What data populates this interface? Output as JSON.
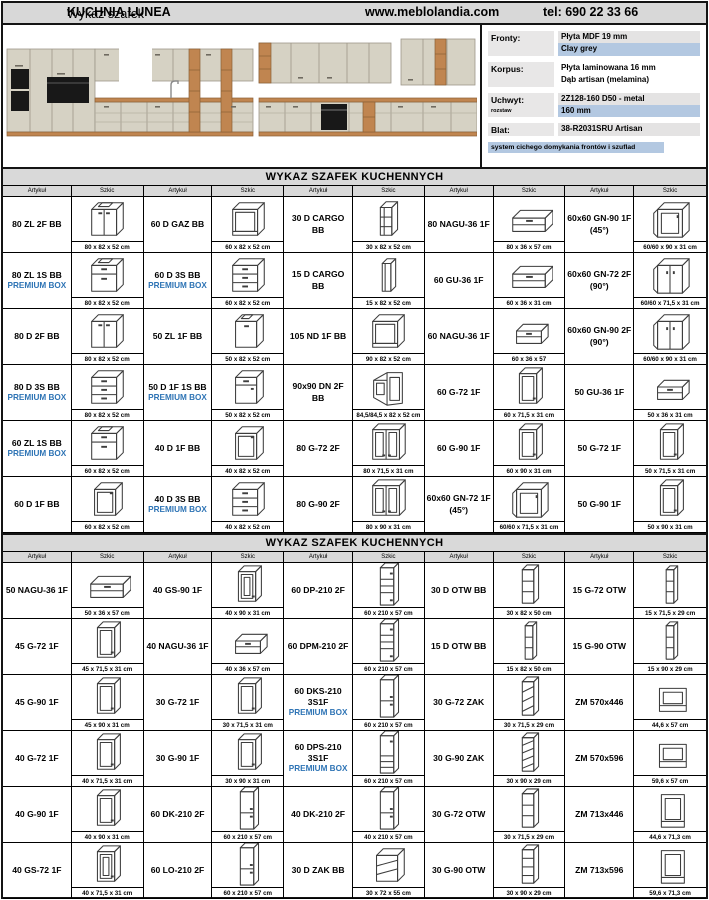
{
  "header": {
    "title_prefix": "Wykaz szafek ",
    "title_name": "KUCHNIA LUNEA",
    "website": "www.meblolandia.com",
    "phone": "tel: 690 22 33 66"
  },
  "colors": {
    "premium_blue": "#2e74b5",
    "highlight_blue": "#b3c8e1",
    "header_grey": "#d9d9d9"
  },
  "specs": {
    "rows": [
      {
        "label": "Fronty:",
        "sublabel": "",
        "values": [
          {
            "text": "Płyta MDF 19 mm",
            "style": "grey"
          },
          {
            "text": "Clay grey",
            "style": "blue"
          }
        ]
      },
      {
        "label": "Korpus:",
        "sublabel": "",
        "values": [
          {
            "text": "Płyta laminowana 16 mm",
            "style": "plain"
          },
          {
            "text": "Dąb artisan (melamina)",
            "style": "plain"
          }
        ]
      },
      {
        "label": "Uchwyt:",
        "sublabel": "rozstaw",
        "values": [
          {
            "text": "2Z128-160 D50 - metal",
            "style": "grey"
          },
          {
            "text": "160 mm",
            "style": "blue"
          }
        ]
      },
      {
        "label": "Blat:",
        "sublabel": "",
        "values": [
          {
            "text": "38-R2031SRU Artisan",
            "style": "grey"
          }
        ]
      }
    ],
    "footer": "system cichego domykania frontów i szuflad"
  },
  "sections": [
    {
      "title": "WYKAZ SZAFEK KUCHENNYCH",
      "col_headers": {
        "article": "Artykuł",
        "sketch": "Szkic"
      },
      "rows": [
        [
          {
            "code": "80 ZL 2F BB",
            "dims": "80 x 82 x 52 cm",
            "sketch": "sink-base-2-doors"
          },
          {
            "code": "60 D GAZ BB",
            "dims": "60 x 82 x 52 cm",
            "sketch": "open-base"
          },
          {
            "code": "30 D CARGO BB",
            "dims": "30 x 82 x 52 cm",
            "sketch": "cargo"
          },
          {
            "code": "80 NAGU-36 1F",
            "dims": "80 x 36 x 57 cm",
            "sketch": "flip-up-wall"
          },
          {
            "code": "60x60 GN-90 1F",
            "code2": "(45°)",
            "dims": "60/60 x 90 x 31 cm",
            "sketch": "corner-wall-1f"
          }
        ],
        [
          {
            "code": "80 ZL 1S BB",
            "premium": "PREMIUM BOX",
            "dims": "80 x 82 x 52 cm",
            "sketch": "sink-base-drawer"
          },
          {
            "code": "60 D 3S BB",
            "premium": "PREMIUM BOX",
            "dims": "60 x 82 x 52 cm",
            "sketch": "drawer-base-3"
          },
          {
            "code": "15 D CARGO BB",
            "dims": "15 x 82 x 52 cm",
            "sketch": "cargo-narrow"
          },
          {
            "code": "60 GU-36 1F",
            "dims": "60 x 36 x 31 cm",
            "sketch": "flip-up-wall"
          },
          {
            "code": "60x60 GN-72 2F",
            "code2": "(90°)",
            "dims": "60/60 x 71,5 x 31 cm",
            "sketch": "corner-wall-2f"
          }
        ],
        [
          {
            "code": "80 D 2F BB",
            "dims": "80 x 82 x 52 cm",
            "sketch": "base-2-doors"
          },
          {
            "code": "50 ZL 1F BB",
            "dims": "50 x 82 x 52 cm",
            "sketch": "sink-base-1-door"
          },
          {
            "code": "105 ND 1F BB",
            "dims": "90 x 82 x 52 cm",
            "sketch": "open-base"
          },
          {
            "code": "60 NAGU-36 1F",
            "dims": "60 x 36 x 57",
            "sketch": "flip-up-wall-small"
          },
          {
            "code": "60x60 GN-90 2F",
            "code2": "(90°)",
            "dims": "60/60 x 90 x 31 cm",
            "sketch": "corner-wall-2f"
          }
        ],
        [
          {
            "code": "80 D 3S BB",
            "premium": "PREMIUM BOX",
            "dims": "80 x 82 x 52 cm",
            "sketch": "drawer-base-3"
          },
          {
            "code": "50 D 1F 1S BB",
            "premium": "PREMIUM BOX",
            "dims": "50 x 82 x 52 cm",
            "sketch": "drawer-door-base"
          },
          {
            "code": "90x90 DN 2F BB",
            "dims": "84,5/84,5 x 82 x 52 cm",
            "sketch": "corner-base"
          },
          {
            "code": "60 G-72 1F",
            "dims": "60 x 71,5 x 31 cm",
            "sketch": "wall-1-door"
          },
          {
            "code": "50 GU-36 1F",
            "dims": "50 x 36 x 31 cm",
            "sketch": "flip-up-wall-small"
          }
        ],
        [
          {
            "code": "60 ZL 1S BB",
            "premium": "PREMIUM BOX",
            "dims": "60 x 82 x 52 cm",
            "sketch": "sink-base-drawer"
          },
          {
            "code": "40 D 1F BB",
            "dims": "40 x 82 x 52 cm",
            "sketch": "base-1-door"
          },
          {
            "code": "80 G-72 2F",
            "dims": "80 x 71,5 x 31 cm",
            "sketch": "wall-2-doors"
          },
          {
            "code": "60 G-90 1F",
            "dims": "60 x 90 x 31 cm",
            "sketch": "wall-1-door"
          },
          {
            "code": "50 G-72 1F",
            "dims": "50 x 71,5 x 31 cm",
            "sketch": "wall-1-door"
          }
        ],
        [
          {
            "code": "60 D 1F BB",
            "dims": "60 x 82 x 52 cm",
            "sketch": "base-1-door"
          },
          {
            "code": "40 D 3S BB",
            "premium": "PREMIUM BOX",
            "dims": "40 x 82 x 52 cm",
            "sketch": "drawer-base-3"
          },
          {
            "code": "80 G-90 2F",
            "dims": "80 x 90 x 31 cm",
            "sketch": "wall-2-doors"
          },
          {
            "code": "60x60 GN-72 1F",
            "code2": "(45°)",
            "dims": "60/60 x 71,5 x 31 cm",
            "sketch": "corner-wall-1f"
          },
          {
            "code": "50 G-90 1F",
            "dims": "50 x 90 x 31 cm",
            "sketch": "wall-1-door"
          }
        ]
      ]
    },
    {
      "title": "WYKAZ SZAFEK KUCHENNYCH",
      "col_headers": {
        "article": "Artykuł",
        "sketch": "Szkic"
      },
      "rows": [
        [
          {
            "code": "50 NAGU-36 1F",
            "dims": "50 x 36 x 57 cm",
            "sketch": "flip-up-wall"
          },
          {
            "code": "40 GS-90 1F",
            "dims": "40 x 90 x 31 cm",
            "sketch": "glass-wall-1-door"
          },
          {
            "code": "60 DP-210 2F",
            "dims": "60 x 210 x 57 cm",
            "sketch": "tall-shelf"
          },
          {
            "code": "30 D OTW BB",
            "dims": "30 x 82 x 50 cm",
            "sketch": "open-shelf-3"
          },
          {
            "code": "15 G-72 OTW",
            "dims": "15 x 71,5 x 29 cm",
            "sketch": "open-shelf-narrow"
          }
        ],
        [
          {
            "code": "45 G-72 1F",
            "dims": "45 x 71,5 x 31 cm",
            "sketch": "wall-1-door"
          },
          {
            "code": "40 NAGU-36 1F",
            "dims": "40 x 36 x 57 cm",
            "sketch": "flip-up-wall-small"
          },
          {
            "code": "60 DPM-210 2F",
            "dims": "60 x 210 x 57 cm",
            "sketch": "tall-shelf"
          },
          {
            "code": "15 D OTW BB",
            "dims": "15 x 82 x 50 cm",
            "sketch": "open-shelf-narrow"
          },
          {
            "code": "15 G-90 OTW",
            "dims": "15 x 90 x 29 cm",
            "sketch": "open-shelf-narrow"
          }
        ],
        [
          {
            "code": "45 G-90 1F",
            "dims": "45 x 90 x 31 cm",
            "sketch": "wall-1-door"
          },
          {
            "code": "30 G-72 1F",
            "dims": "30 x 71,5 x 31 cm",
            "sketch": "wall-1-door"
          },
          {
            "code": "60 DKS-210 3S1F",
            "premium": "PREMIUM BOX",
            "dims": "60 x 210 x 57 cm",
            "sketch": "tall-2-doors"
          },
          {
            "code": "30 G-72 ZAK",
            "dims": "30 x 71,5 x 29 cm",
            "sketch": "zak-shelf"
          },
          {
            "code": "ZM 570x446",
            "dims": "44,6 x 57 cm",
            "sketch": "zm-panel-short"
          }
        ],
        [
          {
            "code": "40 G-72 1F",
            "dims": "40 x 71,5 x 31 cm",
            "sketch": "wall-1-door"
          },
          {
            "code": "30 G-90 1F",
            "dims": "30 x 90 x 31 cm",
            "sketch": "wall-1-door"
          },
          {
            "code": "60 DPS-210 3S1F",
            "premium": "PREMIUM BOX",
            "dims": "60 x 210 x 57 cm",
            "sketch": "tall-drawers"
          },
          {
            "code": "30 G-90 ZAK",
            "dims": "30 x 90 x 29 cm",
            "sketch": "zak-shelf-4"
          },
          {
            "code": "ZM 570x596",
            "dims": "59,6 x 57 cm",
            "sketch": "zm-panel-short"
          }
        ],
        [
          {
            "code": "40 G-90 1F",
            "dims": "40 x 90 x 31 cm",
            "sketch": "wall-1-door"
          },
          {
            "code": "60 DK-210 2F",
            "dims": "60 x 210 x 57 cm",
            "sketch": "tall-2-doors"
          },
          {
            "code": "40 DK-210 2F",
            "dims": "40 x 210 x 57 cm",
            "sketch": "tall-2-doors"
          },
          {
            "code": "30 G-72 OTW",
            "dims": "30 x 71,5 x 29 cm",
            "sketch": "open-shelf-3"
          },
          {
            "code": "ZM 713x446",
            "dims": "44,6 x 71,3 cm",
            "sketch": "zm-panel-tall"
          }
        ],
        [
          {
            "code": "40 GS-72 1F",
            "dims": "40 x 71,5 x 31 cm",
            "sketch": "glass-wall-1-door"
          },
          {
            "code": "60 LO-210 2F",
            "dims": "60 x 210 x 57 cm",
            "sketch": "tall-2-doors"
          },
          {
            "code": "30 D ZAK BB",
            "dims": "30 x 72 x 55 cm",
            "sketch": "zak-base"
          },
          {
            "code": "30 G-90 OTW",
            "dims": "30 x 90 x 29 cm",
            "sketch": "open-shelf-4"
          },
          {
            "code": "ZM 713x596",
            "dims": "59,6 x 71,3 cm",
            "sketch": "zm-panel-tall"
          }
        ]
      ]
    }
  ]
}
